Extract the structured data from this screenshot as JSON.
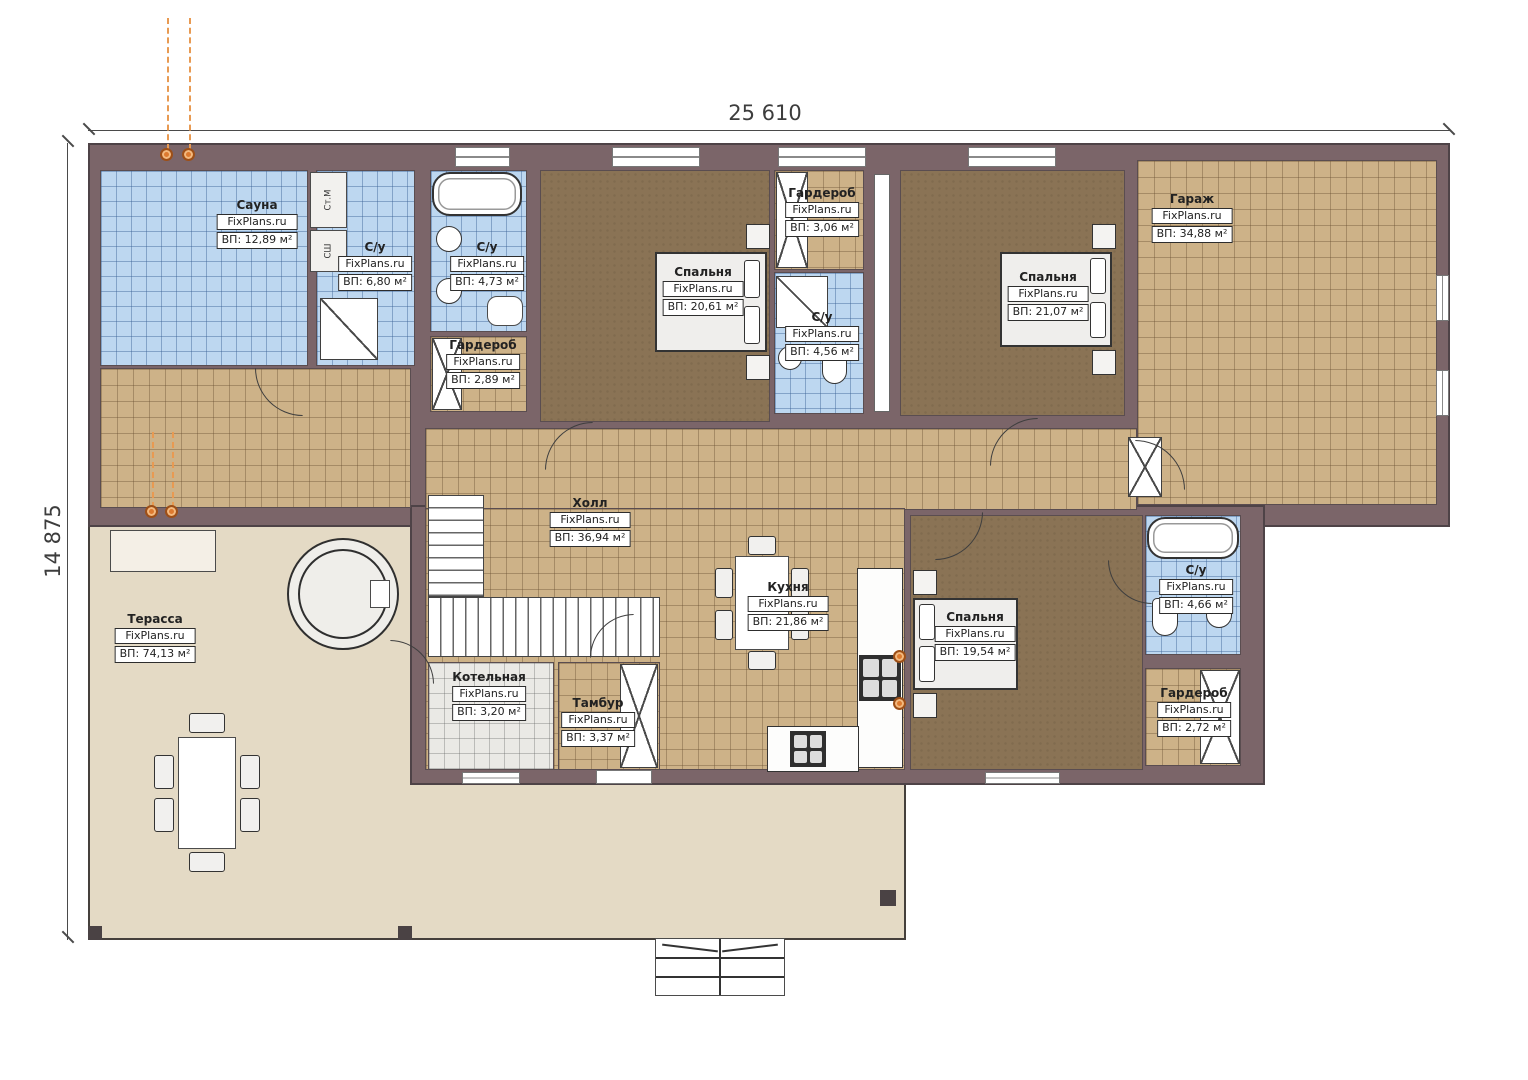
{
  "plan": {
    "brand": "FixPlans.ru",
    "dimensions": {
      "width": "25 610",
      "height": "14 875"
    },
    "appliances": {
      "washer": "Ст.М",
      "dryer": "СШ"
    },
    "rooms": [
      {
        "name": "Сауна",
        "area": "ВП: 12,89 м²"
      },
      {
        "name": "С/у",
        "area": "ВП: 6,80 м²"
      },
      {
        "name": "С/у",
        "area": "ВП: 4,73 м²"
      },
      {
        "name": "Гардероб",
        "area": "ВП: 2,89 м²"
      },
      {
        "name": "Спальня",
        "area": "ВП: 20,61 м²"
      },
      {
        "name": "Гардероб",
        "area": "ВП: 3,06 м²"
      },
      {
        "name": "С/у",
        "area": "ВП: 4,56 м²"
      },
      {
        "name": "Спальня",
        "area": "ВП: 21,07 м²"
      },
      {
        "name": "Гараж",
        "area": "ВП: 34,88 м²"
      },
      {
        "name": "Холл",
        "area": "ВП: 36,94 м²"
      },
      {
        "name": "Кухня",
        "area": "ВП: 21,86 м²"
      },
      {
        "name": "Терасса",
        "area": "ВП: 74,13 м²"
      },
      {
        "name": "Котельная",
        "area": "ВП: 3,20 м²"
      },
      {
        "name": "Тамбур",
        "area": "ВП: 3,37 м²"
      },
      {
        "name": "Спальня",
        "area": "ВП: 19,54 м²"
      },
      {
        "name": "С/у",
        "area": "ВП: 4,66 м²"
      },
      {
        "name": "Гардероб",
        "area": "ВП: 2,72 м²"
      }
    ],
    "colors": {
      "wall": "#7b6569",
      "tile_blue": "#bdd7f0",
      "tile_tan": "#cdb288",
      "floor_brown": "#8a7355",
      "terrace": "#e4dac5",
      "socket": "#dd7a2f"
    }
  }
}
